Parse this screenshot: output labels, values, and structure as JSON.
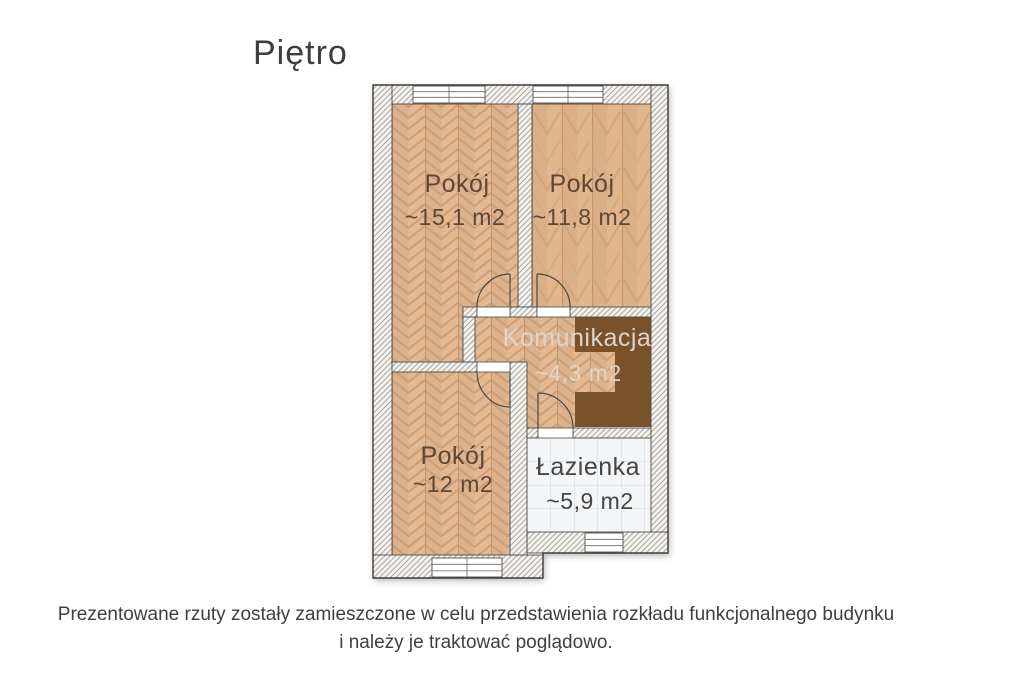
{
  "title": "Piętro",
  "plan": {
    "rooms": [
      {
        "name": "Pokój",
        "area": "~15,1 m2"
      },
      {
        "name": "Pokój",
        "area": "~11,8 m2"
      },
      {
        "name": "Komunikacja",
        "area": "~4,3 m2"
      },
      {
        "name": "Pokój",
        "area": "~12 m2"
      },
      {
        "name": "Łazienka",
        "area": "~5,9 m2"
      }
    ],
    "colors": {
      "wood_floor": "#e4b991",
      "wood_line": "#c79a6f",
      "stairs_brown": "#7a5229",
      "tile_floor": "#f3f5f7",
      "tile_line": "#ccd6de",
      "wall_fill": "#f4f3ef",
      "wall_hatch": "#aba69f",
      "outline": "#4a4a48",
      "room_label": "#5d4837",
      "corridor_label": "#ddd5ca",
      "bath_label": "#454545"
    }
  },
  "disclaimer": {
    "line1": "Prezentowane rzuty zostały zamieszczone w celu przedstawienia rozkładu funkcjonalnego budynku",
    "line2": "i należy je traktować poglądowo."
  }
}
